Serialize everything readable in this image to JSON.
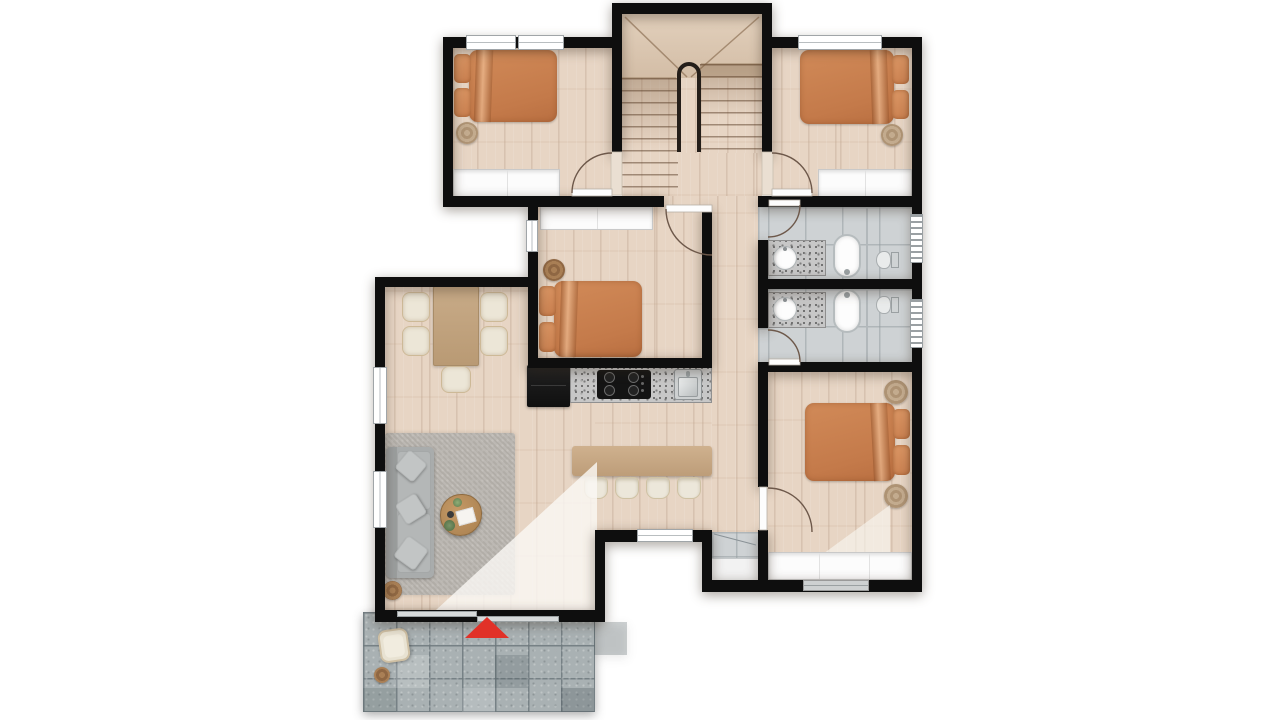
{
  "meta": {
    "type": "architectural-floor-plan",
    "view": "top-down-render",
    "floor_label": "",
    "canvas": {
      "width": 1280,
      "height": 720
    }
  },
  "palette": {
    "wall": "#0e0e0e",
    "wood_floor": "#e7d5c4",
    "bathroom_tile": "#ced2d4",
    "patio_stone": "#a9b1b3",
    "rug": "#b8b4ae",
    "sofa": "#a9acac",
    "bed_duvet": "#c97f4f",
    "bed_pillow": "#d28c5a",
    "chair_cream": "#ece6d7",
    "table_wood": "#c3a584",
    "island_wood": "#c9aa87",
    "granite_counter": "#c7c7c7",
    "appliance_black": "#181818",
    "closet_white": "#fcfcfc",
    "door_arc": "#6d584a",
    "entry_marker": "#e13128"
  },
  "rooms": [
    {
      "id": "bedroom-top-left",
      "furniture": [
        "double-bed",
        "pouf",
        "wardrobe"
      ]
    },
    {
      "id": "staircase",
      "features": [
        "u-shaped-stair",
        "center-railing",
        "winder-landing"
      ]
    },
    {
      "id": "bedroom-top-right",
      "furniture": [
        "double-bed",
        "pouf",
        "wardrobe"
      ]
    },
    {
      "id": "hallway",
      "features": [
        "door-bedroom-left",
        "door-bedroom-right",
        "corridor"
      ]
    },
    {
      "id": "bedroom-middle",
      "furniture": [
        "double-bed",
        "pouf",
        "wardrobe"
      ]
    },
    {
      "id": "bathroom-upper",
      "fixtures": [
        "granite-vanity",
        "round-sink",
        "bathtub",
        "toilet",
        "window"
      ]
    },
    {
      "id": "bathroom-lower",
      "fixtures": [
        "granite-vanity",
        "round-sink",
        "bathtub",
        "toilet",
        "window"
      ]
    },
    {
      "id": "dining-area",
      "furniture": [
        "dining-table",
        "chair",
        "chair",
        "chair",
        "chair",
        "chair"
      ]
    },
    {
      "id": "kitchen",
      "fixtures": [
        "refrigerator",
        "granite-counter",
        "gas-cooktop",
        "sink",
        "island-bar",
        "stool",
        "stool",
        "stool",
        "stool"
      ]
    },
    {
      "id": "living-room",
      "furniture": [
        "corner-sofa",
        "coffee-table",
        "area-rug",
        "round-stool"
      ]
    },
    {
      "id": "bedroom-bottom-right",
      "furniture": [
        "double-bed",
        "pouf",
        "pouf",
        "closet"
      ]
    },
    {
      "id": "storage-nook",
      "features": [
        "tiled-floor"
      ]
    },
    {
      "id": "patio",
      "furniture": [
        "wicker-chair",
        "round-planter"
      ],
      "markers": [
        "entry-arrow"
      ]
    }
  ],
  "markers": {
    "entry": {
      "shape": "triangle",
      "color": "#e13128"
    }
  }
}
